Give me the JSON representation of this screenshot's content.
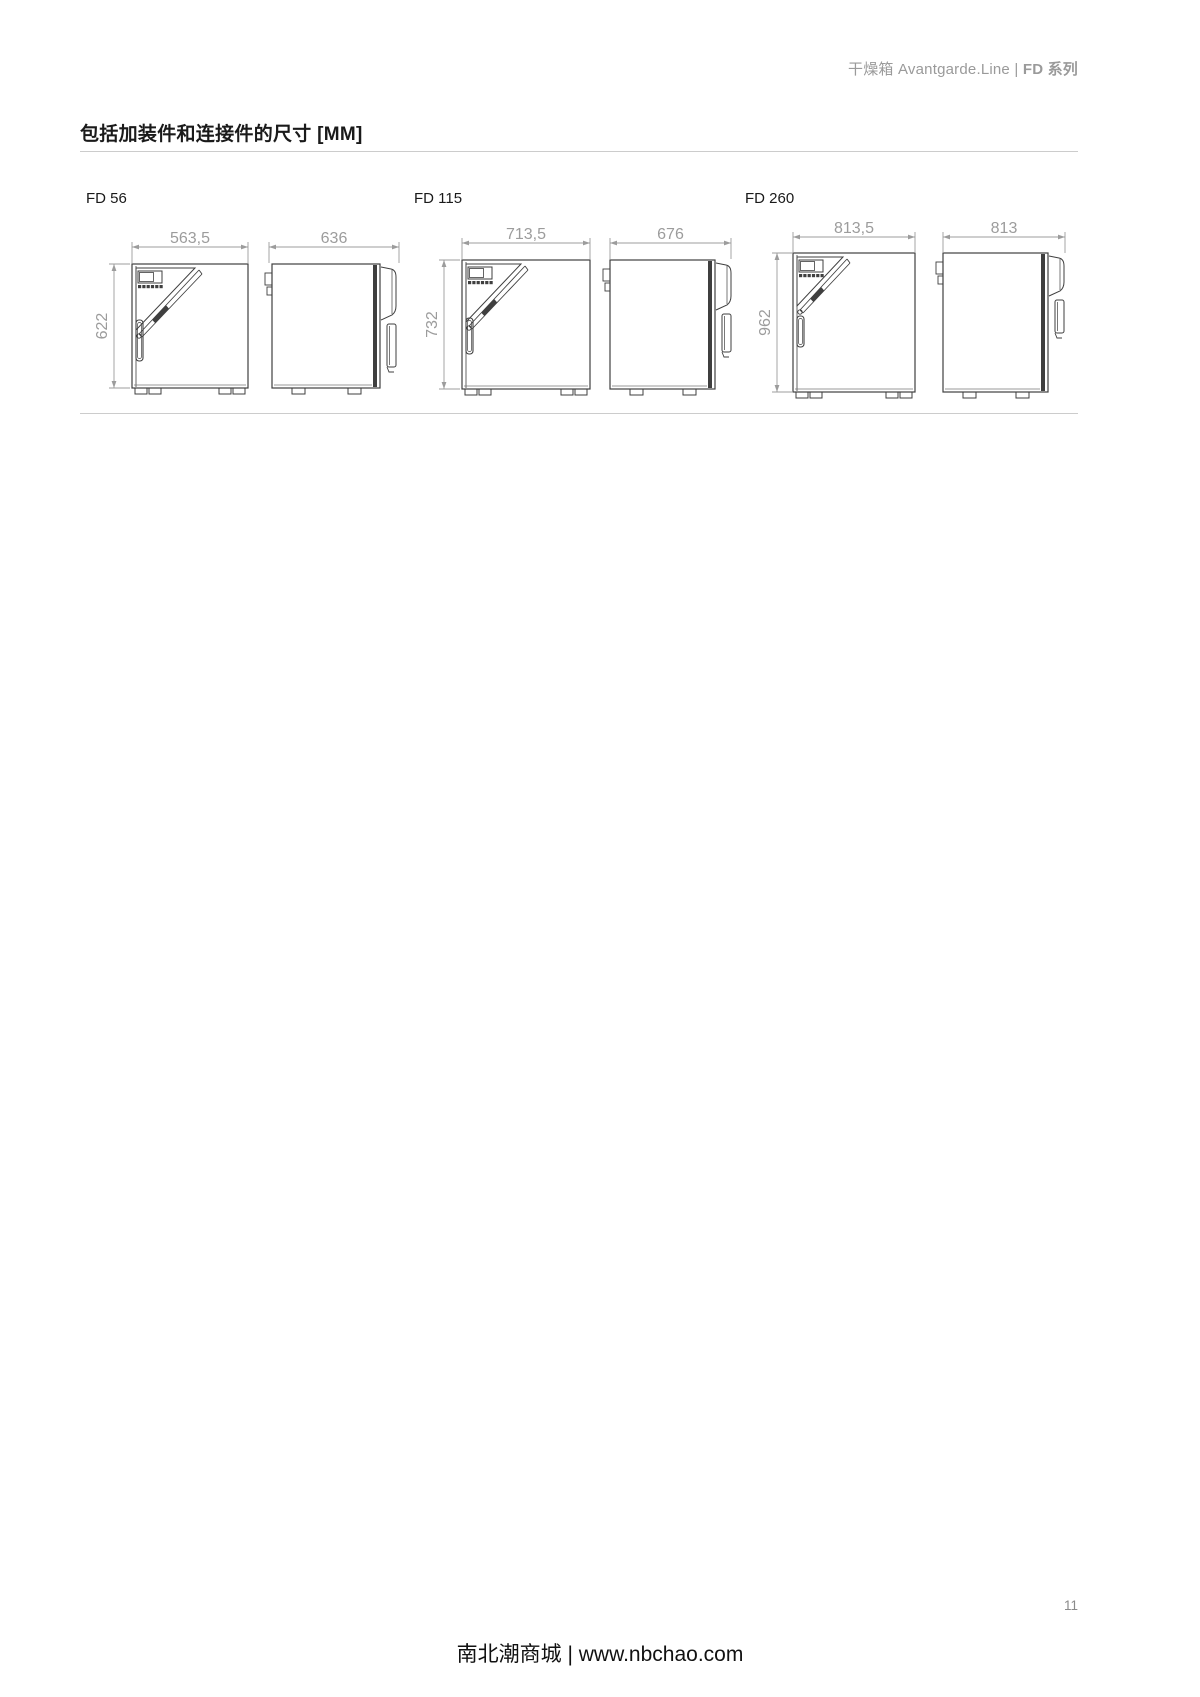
{
  "header": {
    "prefix": "干燥箱 Avantgarde.Line",
    "separator": " | ",
    "series": "FD 系列"
  },
  "title": "包括加装件和连接件的尺寸 [MM]",
  "models": [
    {
      "name": "FD 56",
      "front_width_mm": "563,5",
      "depth_mm": "636",
      "height_mm": "622"
    },
    {
      "name": "FD 115",
      "front_width_mm": "713,5",
      "depth_mm": "676",
      "height_mm": "732"
    },
    {
      "name": "FD 260",
      "front_width_mm": "813,5",
      "depth_mm": "813",
      "height_mm": "962"
    }
  ],
  "page_number": "11",
  "footer": "南北潮商城 | www.nbchao.com",
  "colors": {
    "drawing_line": "#3f3f3f",
    "dimension": "#9c9c9c",
    "rule": "#cccccc",
    "header_text": "#9a9a9a",
    "title_text": "#1a1a1a"
  }
}
